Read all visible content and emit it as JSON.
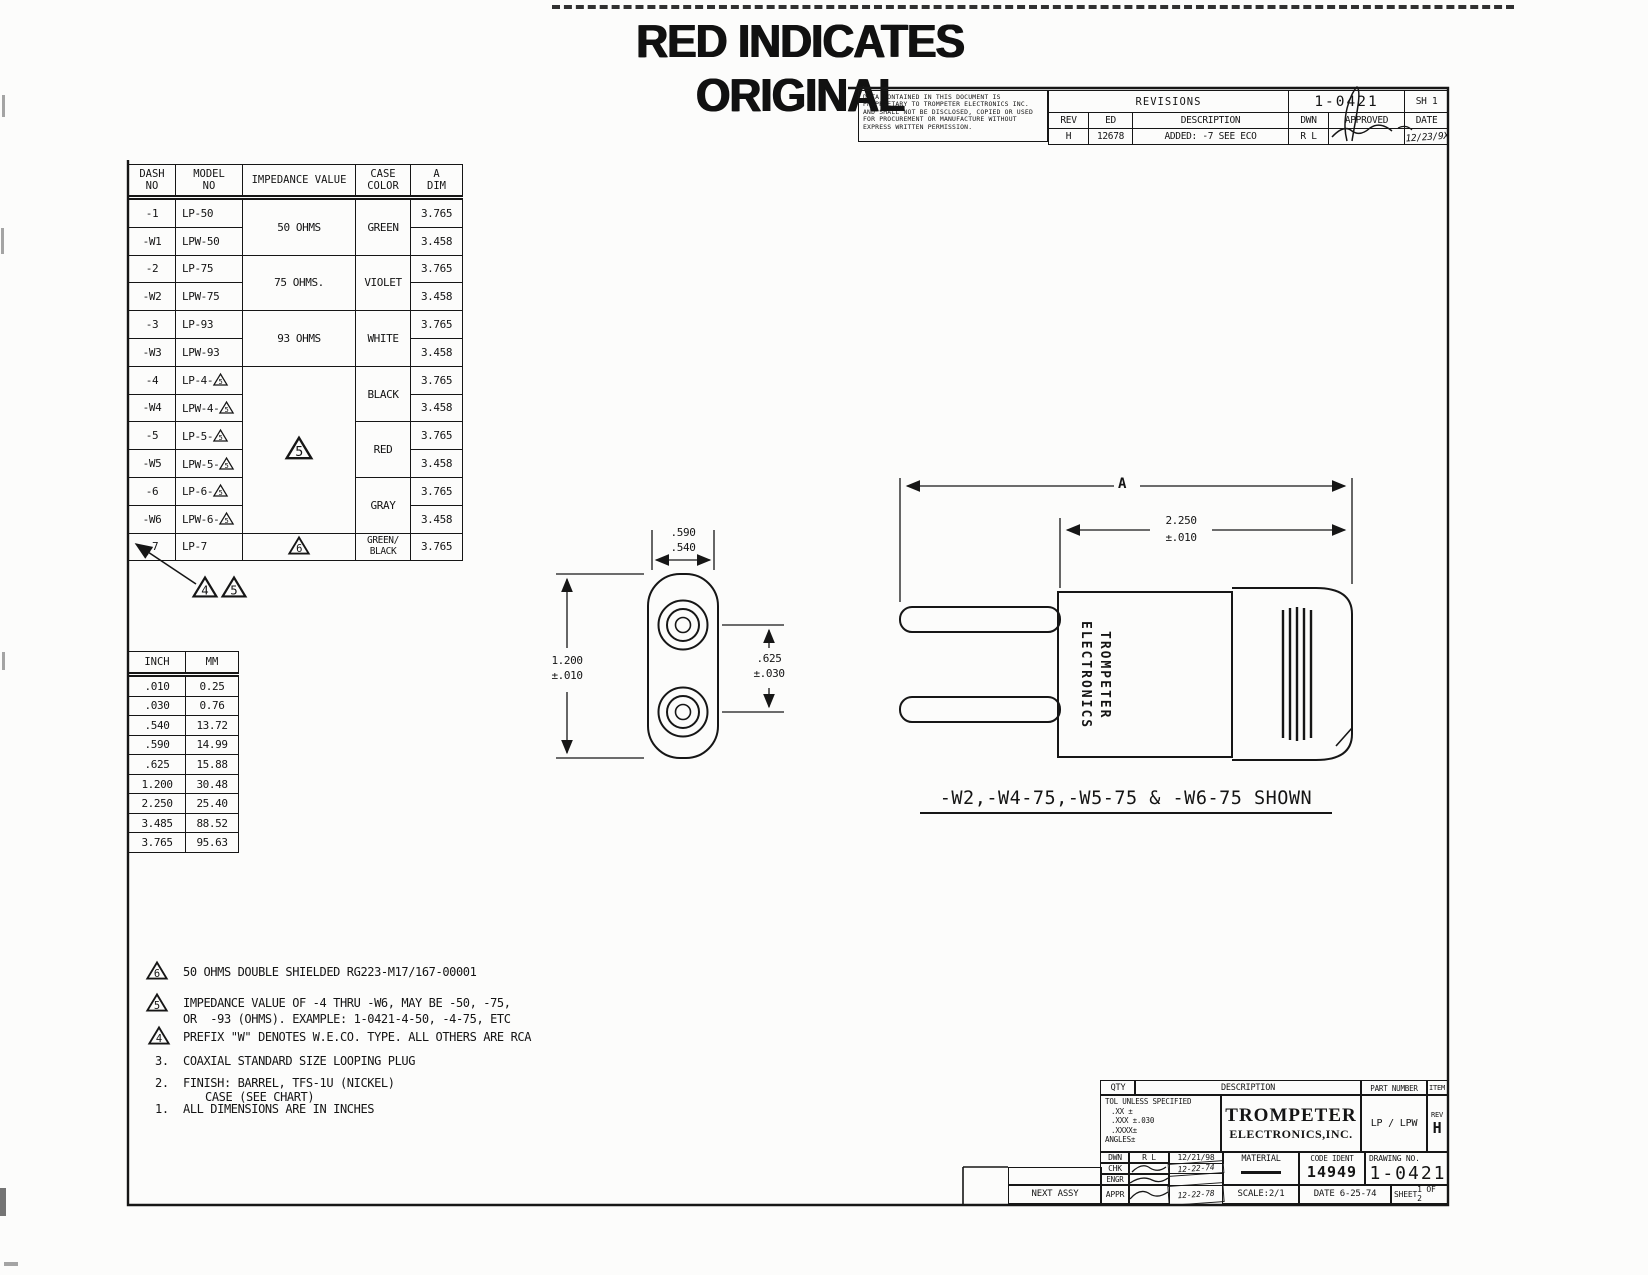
{
  "banner": "RED INDICATES ORIGINAL",
  "flags": {
    "f4": "4",
    "f5": "5",
    "f6": "6"
  },
  "revisions_block": {
    "proprietary": "DATA CONTAINED IN THIS DOCUMENT IS PROPRIETARY TO TROMPETER ELECTRONICS INC. AND SHALL NOT BE DISCLOSED, COPIED OR USED FOR PROCUREMENT OR MANUFACTURE WITHOUT EXPRESS WRITTEN PERMISSION.",
    "title": "REVISIONS",
    "doc_number": "1-0421",
    "sheet_tag": "SH 1",
    "headers": {
      "rev": "REV",
      "ed": "ED",
      "description": "DESCRIPTION",
      "dwn": "DWN",
      "approved": "APPROVED",
      "date": "DATE"
    },
    "entry": {
      "rev": "H",
      "ed": "12678",
      "description": "ADDED: -7 SEE ECO",
      "dwn": "R L",
      "date": "12/23/9X"
    }
  },
  "parts_table": {
    "headers": {
      "dash1": "DASH",
      "dash2": "NO",
      "model1": "MODEL",
      "model2": "NO",
      "impedance": "IMPEDANCE VALUE",
      "case1": "CASE",
      "case2": "COLOR",
      "adim1": "A",
      "adim2": "DIM"
    },
    "impedances": {
      "g50": "50 OHMS",
      "g75": "75 OHMS.",
      "g93": "93 OHMS"
    },
    "colors": {
      "green": "GREEN",
      "violet": "VIOLET",
      "white": "WHITE",
      "black": "BLACK",
      "red": "RED",
      "gray": "GRAY",
      "greenblack1": "GREEN/",
      "greenblack2": "BLACK"
    },
    "rows": [
      {
        "dash": "-1",
        "model": "LP-50",
        "a": "3.765"
      },
      {
        "dash": "-W1",
        "model": "LPW-50",
        "a": "3.458"
      },
      {
        "dash": "-2",
        "model": "LP-75",
        "a": "3.765"
      },
      {
        "dash": "-W2",
        "model": "LPW-75",
        "a": "3.458"
      },
      {
        "dash": "-3",
        "model": "LP-93",
        "a": "3.765"
      },
      {
        "dash": "-W3",
        "model": "LPW-93",
        "a": "3.458"
      },
      {
        "dash": "-4",
        "model": "LP-4-",
        "a": "3.765"
      },
      {
        "dash": "-W4",
        "model": "LPW-4-",
        "a": "3.458"
      },
      {
        "dash": "-5",
        "model": "LP-5-",
        "a": "3.765"
      },
      {
        "dash": "-W5",
        "model": "LPW-5-",
        "a": "3.458"
      },
      {
        "dash": "-6",
        "model": "LP-6-",
        "a": "3.765"
      },
      {
        "dash": "-W6",
        "model": "LPW-6-",
        "a": "3.458"
      },
      {
        "dash": "-7",
        "model": "LP-7",
        "a": "3.765"
      }
    ]
  },
  "conversion_table": {
    "headers": {
      "inch": "INCH",
      "mm": "MM"
    },
    "rows": [
      {
        "inch": ".010",
        "mm": "0.25"
      },
      {
        "inch": ".030",
        "mm": "0.76"
      },
      {
        "inch": ".540",
        "mm": "13.72"
      },
      {
        "inch": ".590",
        "mm": "14.99"
      },
      {
        "inch": ".625",
        "mm": "15.88"
      },
      {
        "inch": "1.200",
        "mm": "30.48"
      },
      {
        "inch": "2.250",
        "mm": "25.40"
      },
      {
        "inch": "3.485",
        "mm": "88.52"
      },
      {
        "inch": "3.765",
        "mm": "95.63"
      }
    ]
  },
  "notes": {
    "flag6_text": "50 OHMS DOUBLE SHIELDED RG223-M17/167-00001",
    "flag5_line1": "IMPEDANCE VALUE OF -4 THRU -W6, MAY BE -50, -75,",
    "flag5_line2": "OR  -93 (OHMS). EXAMPLE: 1-0421-4-50, -4-75, ETC",
    "flag4_text": "PREFIX \"W\" DENOTES W.E.CO. TYPE. ALL OTHERS ARE RCA",
    "n3_num": "3.",
    "n3_text": "COAXIAL STANDARD SIZE LOOPING PLUG",
    "n2_num": "2.",
    "n2_line1": "FINISH: BARREL, TFS-1U (NICKEL)",
    "n2_line2": "CASE (SEE CHART)",
    "n1_num": "1.",
    "n1_text": "ALL DIMENSIONS ARE IN INCHES"
  },
  "dimensions": {
    "front_top_1": ".590",
    "front_top_2": ".540",
    "front_left_1": "1.200",
    "front_left_2": "±.010",
    "front_right_1": ".625",
    "front_right_2": "±.030",
    "side_a": "A",
    "side_len_1": "2.250",
    "side_len_2": "±.010",
    "body_line1": "TROMPETER",
    "body_line2": "ELECTRONICS"
  },
  "shown_label": "-W2,-W4-75,-W5-75 & -W6-75 SHOWN",
  "title_block": {
    "qty": "QTY",
    "description": "DESCRIPTION",
    "part_number": "PART NUMBER",
    "item": "ITEM",
    "tol_line1": "TOL UNLESS SPECIFIED",
    "tol_line2": ".XX ±",
    "tol_line3": ".XXX ±.030",
    "tol_line4": ".XXXX±",
    "tol_line5": "ANGLES±",
    "company1": "TROMPETER",
    "company2": "ELECTRONICS,INC.",
    "part_value": "LP / LPW",
    "rev_label": "REV",
    "rev_value": "H",
    "dwn_label": "DWN",
    "dwn_by": "R L",
    "dwn_date": "12/21/98",
    "chk_label": "CHK",
    "chk_date": "12-22-74",
    "engr_label": "ENGR",
    "appr_label": "APPR",
    "appr_date": "12-22-78",
    "material_label": "MATERIAL",
    "code_ident_label": "CODE IDENT",
    "code_ident": "14949",
    "drawing_no_label": "DRAWING NO.",
    "drawing_no": "1-0421",
    "scale": "SCALE:2/1",
    "date": "DATE 6-25-74",
    "sheet_label": "SHEET",
    "sheet_value": "1 OF 2",
    "next_assy": "NEXT ASSY"
  }
}
